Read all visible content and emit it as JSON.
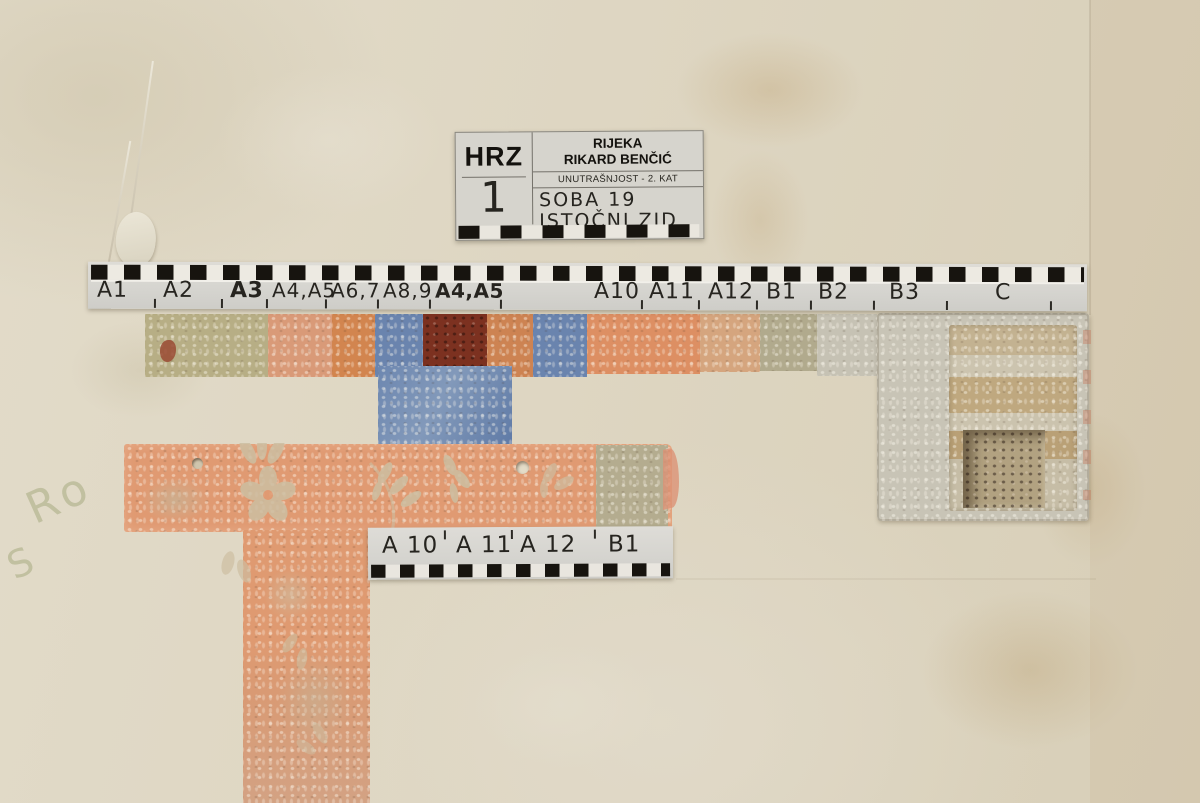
{
  "label_card": {
    "org_code": "HRZ",
    "site_line1": "RIJEKA",
    "site_line2": "RIKARD BENČIĆ",
    "location_line": "UNUTRAŠNJOST - 2. KAT",
    "probe_number": "1",
    "room_line1": "SOBA 19",
    "room_line2": "ISTOČNI ZID"
  },
  "main_scale": {
    "labels": [
      {
        "text": "A1",
        "bold": false
      },
      {
        "text": "A2",
        "bold": false
      },
      {
        "text": "A3",
        "bold": true
      },
      {
        "text": "A4,A5",
        "bold": false
      },
      {
        "text": "A6,7",
        "bold": false
      },
      {
        "text": "A8,9",
        "bold": false
      },
      {
        "text": "A4,A5",
        "bold": true
      },
      {
        "text": "A10",
        "bold": false
      },
      {
        "text": "A11",
        "bold": false
      },
      {
        "text": "A12",
        "bold": false
      },
      {
        "text": "B1",
        "bold": false
      },
      {
        "text": "B2",
        "bold": false
      },
      {
        "text": "B3",
        "bold": false
      },
      {
        "text": "C",
        "bold": false
      }
    ]
  },
  "lower_scale": {
    "labels": [
      "A 10",
      "A 11",
      "A 12",
      "B1"
    ]
  },
  "graffiti": {
    "line1": "Ro",
    "line2": "S"
  },
  "colors": {
    "wall": "#ddd5c2",
    "scale_paper": "#d7d5d0",
    "checker_black": "#17140f",
    "patch_olive": "#b7ae85",
    "patch_salmon": "#d99a78",
    "patch_orange": "#d2854f",
    "patch_blue": "#6a84ae",
    "patch_dark_red": "#7c3120",
    "patch_grey_green": "#b1aa8d",
    "wallpaper_orange": "#df9a71",
    "plaster_grey": "#c8c4b6",
    "brick_tan": "#c0a87f"
  }
}
